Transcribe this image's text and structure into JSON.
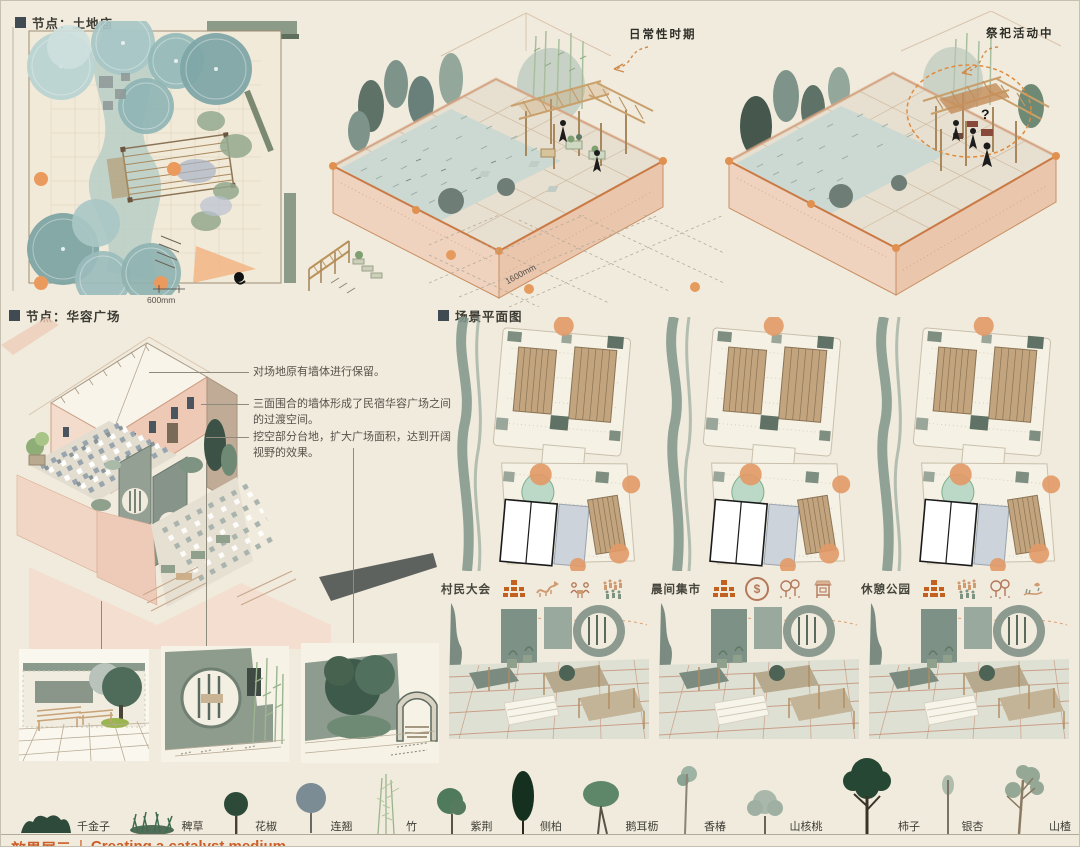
{
  "colors": {
    "background": "#f1ebdd",
    "accent_orange": "#d4652f",
    "terracotta_edge": "#c87b4a",
    "wall_pink": "#eecdb9",
    "sage_green": "#8a9a8c",
    "slate_marker": "#3f4a52",
    "wood_tan": "#c2a47e",
    "watercolor_blue": "#9fc3c4",
    "orange_dot": "#e89a5a"
  },
  "sections": {
    "node_temple": {
      "title": "节点：土地庙",
      "dimension_label": "600mm"
    },
    "axon_daily": {
      "label": "日常性时期",
      "dimension_label": "1600mm"
    },
    "axon_ritual": {
      "label": "祭祀活动中",
      "question_mark": "?"
    },
    "node_plaza": {
      "title": "节点：华容广场",
      "annotations": [
        "对场地原有墙体进行保留。",
        "三面围合的墙体形成了民宿华容广场之间的过渡空间。",
        "挖空部分台地，扩大广场面积，达到开阔视野的效果。"
      ]
    },
    "scene_plans": {
      "title": "场景平面图",
      "coin_symbol": "$",
      "scenes": [
        {
          "label": "村民大会",
          "icons": [
            "assembly-icon",
            "dragon-dance-icon",
            "meeting-icon",
            "crowd-icon"
          ]
        },
        {
          "label": "晨间集市",
          "icons": [
            "assembly-icon",
            "coin-icon",
            "park-trees-icon",
            "market-stall-icon"
          ]
        },
        {
          "label": "休憩公园",
          "icons": [
            "assembly-icon",
            "crowd-icon",
            "park-trees-icon",
            "bird-landscape-icon"
          ]
        }
      ]
    }
  },
  "plant_legend": {
    "items": [
      {
        "name": "千金子"
      },
      {
        "name": "稗草"
      },
      {
        "name": "花椒"
      },
      {
        "name": "连翘"
      },
      {
        "name": "竹"
      },
      {
        "name": "紫荆"
      },
      {
        "name": "侧柏"
      },
      {
        "name": "鹅耳枥"
      },
      {
        "name": "香椿"
      },
      {
        "name": "山核桃"
      },
      {
        "name": "柿子"
      },
      {
        "name": "银杏"
      },
      {
        "name": "山楂"
      }
    ]
  },
  "footer": {
    "zh": "效果展示",
    "divider": "|",
    "en": "Creating a catalyst medium"
  }
}
